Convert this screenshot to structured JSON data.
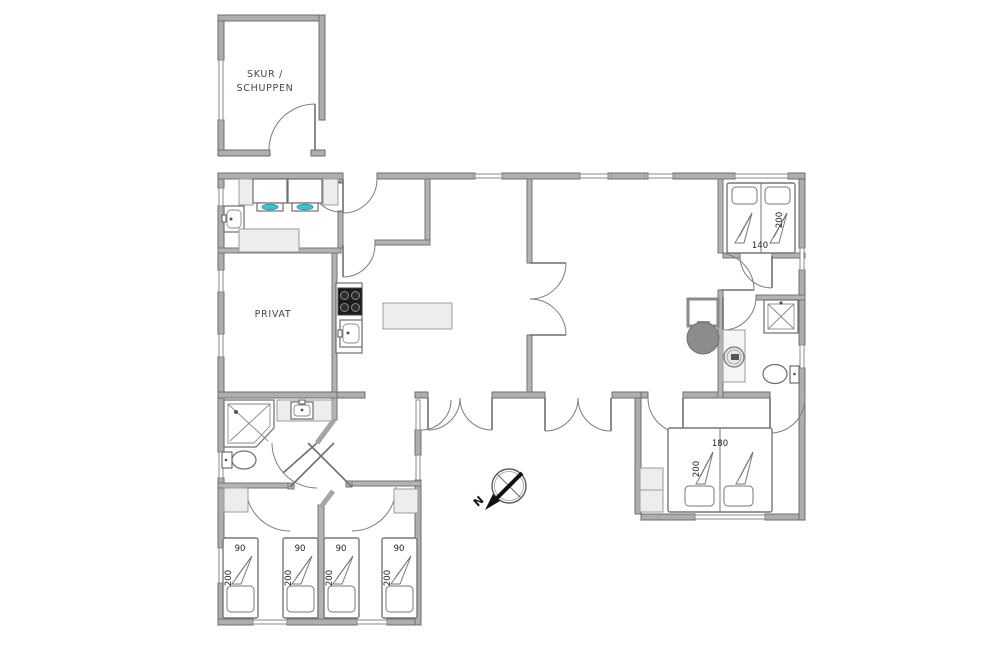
{
  "plan": {
    "labels": {
      "shed_line1": "SKUR /",
      "shed_line2": "SCHUPPEN",
      "privat": "PRIVAT"
    },
    "dimensions": {
      "bed_double_top": {
        "width": "140",
        "length": "200"
      },
      "bed_double_bottom": {
        "width": "180",
        "length": "200"
      },
      "single_beds": [
        {
          "width": "90",
          "length": "200"
        },
        {
          "width": "90",
          "length": "200"
        },
        {
          "width": "90",
          "length": "200"
        },
        {
          "width": "90",
          "length": "200"
        }
      ]
    },
    "compass": {
      "north_label": "N"
    },
    "colors": {
      "wall_fill": "#aeaeae",
      "wall_edge": "#6e6e6e",
      "fixture_light": "#ededed",
      "accent_cyan": "#3fc1d4",
      "stove_black": "#1c1c1c",
      "fireplace_gray": "#8c8c8c",
      "label_color": "#3d4954",
      "dimension_color": "#1f1f1f"
    }
  }
}
